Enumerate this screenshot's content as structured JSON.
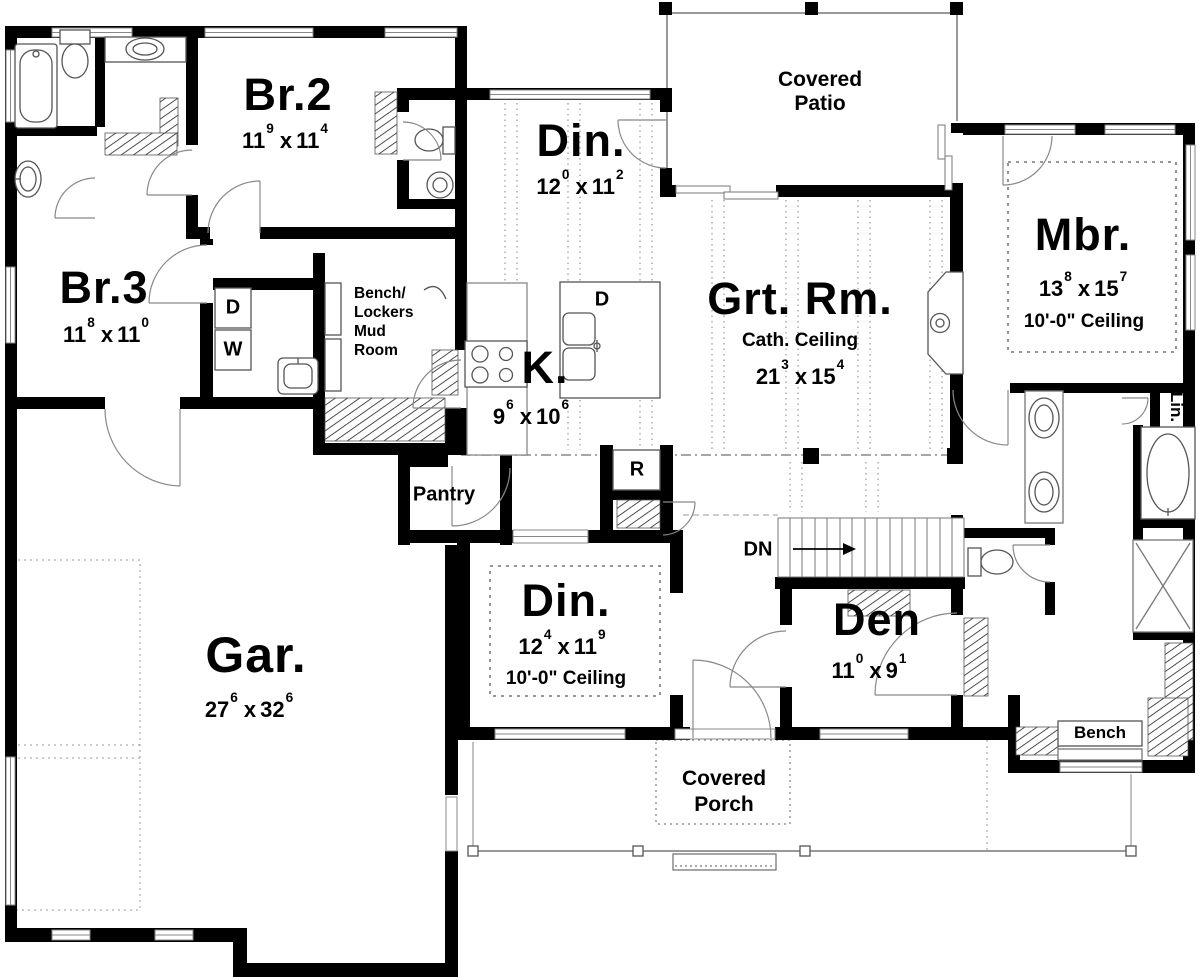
{
  "ui": {
    "dim_sep": "x"
  },
  "rooms": {
    "br2": {
      "label": "Br.2",
      "dim": {
        "a": "11",
        "asup": "9",
        "b": "11",
        "bsup": "4"
      }
    },
    "br3": {
      "label": "Br.3",
      "dim": {
        "a": "11",
        "asup": "8",
        "b": "11",
        "bsup": "0"
      }
    },
    "din1": {
      "label": "Din.",
      "dim": {
        "a": "12",
        "asup": "0",
        "b": "11",
        "bsup": "2"
      }
    },
    "grt": {
      "label": "Grt. Rm.",
      "ceiling": "Cath. Ceiling",
      "dim": {
        "a": "21",
        "asup": "3",
        "b": "15",
        "bsup": "4"
      }
    },
    "mbr": {
      "label": "Mbr.",
      "ceiling": "10'-0\" Ceiling",
      "dim": {
        "a": "13",
        "asup": "8",
        "b": "15",
        "bsup": "7"
      }
    },
    "kitchen": {
      "label": "K.",
      "dim": {
        "a": "9",
        "asup": "6",
        "b": "10",
        "bsup": "6"
      }
    },
    "din2": {
      "label": "Din.",
      "ceiling": "10'-0\" Ceiling",
      "dim": {
        "a": "12",
        "asup": "4",
        "b": "11",
        "bsup": "9"
      }
    },
    "den": {
      "label": "Den",
      "dim": {
        "a": "11",
        "asup": "0",
        "b": "9",
        "bsup": "1"
      }
    },
    "garage": {
      "label": "Gar.",
      "dim": {
        "a": "27",
        "asup": "6",
        "b": "32",
        "bsup": "6"
      }
    }
  },
  "areas": {
    "patio": {
      "line1": "Covered",
      "line2": "Patio"
    },
    "porch": {
      "line1": "Covered",
      "line2": "Porch"
    },
    "mud": {
      "line1": "Bench/",
      "line2": "Lockers",
      "line3": "Mud",
      "line4": "Room"
    },
    "pantry": "Pantry",
    "bench": "Bench",
    "linen": "Lin.",
    "stairs_dn": "DN"
  },
  "appliances": {
    "dryer": "D",
    "washer": "W",
    "dishwasher": "D",
    "range": "R"
  }
}
